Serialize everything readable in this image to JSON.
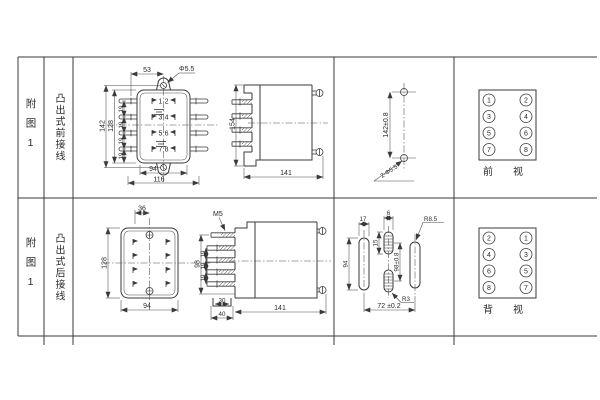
{
  "colors": {
    "line": "#3a3a3a",
    "background": "#ffffff"
  },
  "rows": [
    {
      "fig_label": "附图1",
      "wiring_label": "凸出式前接线",
      "front_view": {
        "dim_top_width": "53",
        "hole_label": "Φ5.5",
        "dim_height_outer": "142",
        "dim_height_inner": "128",
        "dim_pitch": [
          "19",
          "19",
          "19",
          "19"
        ],
        "pin_numbers": [
          "1",
          "2",
          "3",
          "4",
          "5",
          "6",
          "7",
          "8"
        ],
        "dim_bottom_inner": "94",
        "dim_bottom_outer": "116"
      },
      "side_view": {
        "dim_height": "154",
        "dim_depth": "141"
      },
      "drill_view": {
        "dim_hole_spacing": "142±0.8",
        "holes_label": "2-Φ5.5"
      },
      "terminal_view": {
        "left_column": [
          "1",
          "3",
          "5",
          "7"
        ],
        "right_column": [
          "2",
          "4",
          "6",
          "8"
        ],
        "caption": "前视"
      }
    },
    {
      "fig_label": "附图1",
      "wiring_label": "凸出式后接线",
      "rear_view": {
        "dim_top": "36",
        "dim_height": "128",
        "dim_bottom": "94"
      },
      "side_view": {
        "thread_label": "M5",
        "dim_height": "98",
        "dim_pitch": [
          "19",
          "19",
          "19"
        ],
        "dim_tab_inner": "30",
        "dim_tab_outer": "40",
        "dim_depth": "141"
      },
      "cutout_view": {
        "dim_slot_width_left": "17",
        "dim_slot_width_center": "6",
        "dim_slot_length_center": "15",
        "dim_slot_length_left": "94",
        "dim_center_spacing": "98±0.8",
        "radius_right": "R8.5",
        "radius_center": "R3",
        "dim_span": "72 ±0.2"
      },
      "terminal_view": {
        "left_column": [
          "2",
          "4",
          "6",
          "8"
        ],
        "right_column": [
          "1",
          "3",
          "5",
          "7"
        ],
        "caption": "背视"
      }
    }
  ]
}
